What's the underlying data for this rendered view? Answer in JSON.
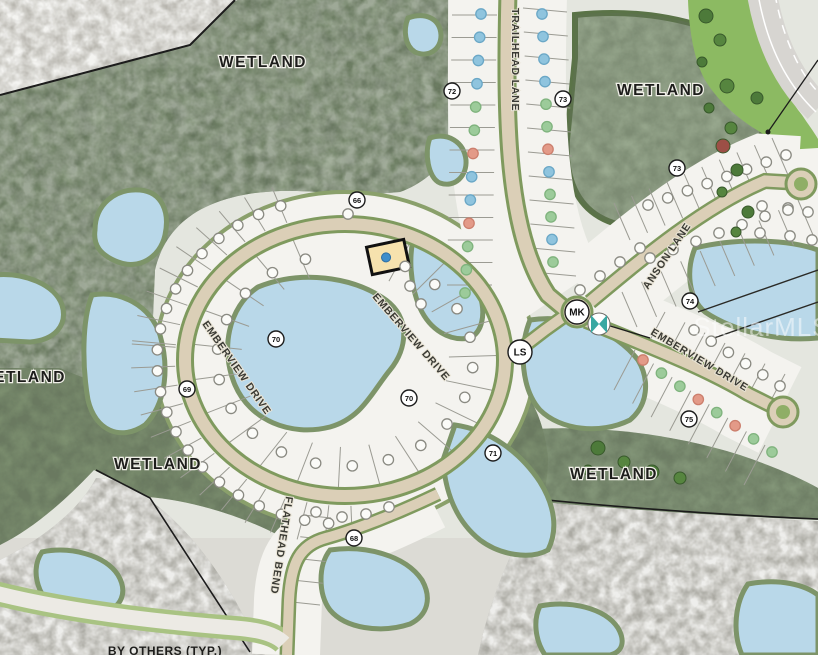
{
  "map": {
    "watermark": {
      "text": "StellarMLS",
      "x": 762,
      "y": 336,
      "size": 26,
      "color": "#ffffff",
      "opacity": 0.5
    },
    "area_labels": [
      {
        "text": "WETLAND",
        "x": 263,
        "y": 67
      },
      {
        "text": "WETLAND",
        "x": 661,
        "y": 95
      },
      {
        "text": "WETLAND",
        "x": 22,
        "y": 382
      },
      {
        "text": "WETLAND",
        "x": 158,
        "y": 469
      },
      {
        "text": "WETLAND",
        "x": 614,
        "y": 479
      }
    ],
    "note_labels": [
      {
        "text": "BY OTHERS (TYP.)",
        "x": 165,
        "y": 655
      }
    ],
    "street_labels": [
      {
        "text": "TRAILHEAD LANE",
        "x": 512,
        "y": 8,
        "rotate": 90
      },
      {
        "text": "EMBERVIEW DRIVE",
        "x": 372,
        "y": 297,
        "rotate": 49
      },
      {
        "text": "EMBERVIEW DRIVE",
        "x": 202,
        "y": 324,
        "rotate": 55
      },
      {
        "text": "EMBERVIEW DRIVE",
        "x": 650,
        "y": 334,
        "rotate": 31
      },
      {
        "text": "ANSON LANE",
        "x": 648,
        "y": 290,
        "rotate": -56
      },
      {
        "text": "FLATHEAD BEND",
        "x": 286,
        "y": 496,
        "rotate": 99
      }
    ],
    "markers": [
      {
        "label": "72",
        "x": 452,
        "y": 91,
        "size": "s"
      },
      {
        "label": "73",
        "x": 563,
        "y": 99,
        "size": "s"
      },
      {
        "label": "66",
        "x": 357,
        "y": 200,
        "size": "s"
      },
      {
        "label": "73",
        "x": 677,
        "y": 168,
        "size": "s"
      },
      {
        "label": "74",
        "x": 690,
        "y": 301,
        "size": "s"
      },
      {
        "label": "75",
        "x": 689,
        "y": 419,
        "size": "s"
      },
      {
        "label": "70",
        "x": 276,
        "y": 339,
        "size": "s"
      },
      {
        "label": "69",
        "x": 187,
        "y": 389,
        "size": "s"
      },
      {
        "label": "70",
        "x": 409,
        "y": 398,
        "size": "s"
      },
      {
        "label": "71",
        "x": 493,
        "y": 453,
        "size": "s"
      },
      {
        "label": "68",
        "x": 354,
        "y": 538,
        "size": "s"
      },
      {
        "label": "MK",
        "x": 577,
        "y": 312,
        "size": "l"
      },
      {
        "label": "LS",
        "x": 520,
        "y": 352,
        "size": "l"
      }
    ],
    "highlighted_lot": {
      "x": 388,
      "y": 257,
      "w": 38,
      "h": 28,
      "rotate": -12,
      "fill": "#f6e2ae",
      "border": "#111111",
      "dot": "#3f8ecb"
    },
    "dot_colors": {
      "o": {
        "fill": "#fbfbf8",
        "stroke": "#8a8a82"
      },
      "t": {
        "fill": "#8fc4de",
        "stroke": "#6aa7c6"
      },
      "g": {
        "fill": "#9ccb9a",
        "stroke": "#7fb37d"
      },
      "r": {
        "fill": "#e39a88",
        "stroke": "#cc7f6d"
      }
    },
    "dot_rows": [
      {
        "type": "line",
        "x1": 481,
        "y1": 14,
        "x2": 465,
        "y2": 293,
        "count": 13,
        "colors": "ttttggrttrggg"
      },
      {
        "type": "line",
        "x1": 542,
        "y1": 14,
        "x2": 553,
        "y2": 262,
        "count": 12,
        "colors": "ttttggrtggtg"
      },
      {
        "type": "arc",
        "cx": 345,
        "cy": 360,
        "rx": 188,
        "ry": 164,
        "a1": 250,
        "a2": 95,
        "count": 22,
        "colors": "o"
      },
      {
        "type": "arc",
        "cx": 345,
        "cy": 360,
        "rx": 128,
        "ry": 106,
        "a1": 252,
        "a2": -62,
        "count": 20,
        "colors": "o"
      },
      {
        "type": "line",
        "x1": 648,
        "y1": 205,
        "x2": 786,
        "y2": 155,
        "count": 8,
        "colors": "o"
      },
      {
        "type": "line",
        "x1": 650,
        "y1": 258,
        "x2": 788,
        "y2": 208,
        "count": 7,
        "colors": "o"
      },
      {
        "type": "line",
        "x1": 580,
        "y1": 290,
        "x2": 640,
        "y2": 248,
        "count": 4,
        "colors": "o"
      },
      {
        "type": "line",
        "x1": 694,
        "y1": 330,
        "x2": 780,
        "y2": 386,
        "count": 6,
        "colors": "o"
      },
      {
        "type": "line",
        "x1": 643,
        "y1": 360,
        "x2": 772,
        "y2": 452,
        "count": 8,
        "colors": "rggrgrgg"
      },
      {
        "type": "list",
        "pts": [
          [
            762,
            206
          ],
          [
            788,
            210
          ],
          [
            808,
            212
          ],
          [
            760,
            233
          ],
          [
            790,
            236
          ],
          [
            812,
            240
          ]
        ],
        "colors": "o"
      },
      {
        "type": "list",
        "pts": [
          [
            316,
            512
          ],
          [
            342,
            517
          ],
          [
            366,
            514
          ],
          [
            389,
            507
          ]
        ],
        "colors": "o"
      },
      {
        "type": "list",
        "pts": [
          [
            348,
            214
          ],
          [
            410,
            286
          ],
          [
            421,
            304
          ]
        ],
        "colors": "o"
      }
    ],
    "tick_rows": [
      {
        "type": "radial",
        "cx": 345,
        "cy": 360,
        "rx1": 170,
        "ry1": 146,
        "rx2": 214,
        "ry2": 184,
        "a1": 185,
        "a2": 88,
        "count": 14
      },
      {
        "type": "radial",
        "cx": 345,
        "cy": 360,
        "rx1": 170,
        "ry1": 146,
        "rx2": 214,
        "ry2": 184,
        "a1": 250,
        "a2": 186,
        "count": 9
      },
      {
        "type": "radial",
        "cx": 345,
        "cy": 360,
        "rx1": 104,
        "ry1": 87,
        "rx2": 152,
        "ry2": 128,
        "a1": 250,
        "a2": -65,
        "count": 21
      },
      {
        "type": "band",
        "x1": 452,
        "y1": 15,
        "x2": 447,
        "y2": 285,
        "dx": 45,
        "dy": 0,
        "count": 13
      },
      {
        "type": "band",
        "x1": 523,
        "y1": 8,
        "x2": 532,
        "y2": 272,
        "dx": 44,
        "dy": 4,
        "count": 12
      },
      {
        "type": "band",
        "x1": 630,
        "y1": 240,
        "x2": 788,
        "y2": 175,
        "dx": -16,
        "dy": -37,
        "count": 10
      },
      {
        "type": "band",
        "x1": 622,
        "y1": 292,
        "x2": 798,
        "y2": 200,
        "dx": 15,
        "dy": 35,
        "count": 10
      },
      {
        "type": "band",
        "x1": 650,
        "y1": 340,
        "x2": 770,
        "y2": 402,
        "dx": 15,
        "dy": -28,
        "count": 7
      },
      {
        "type": "band",
        "x1": 635,
        "y1": 350,
        "x2": 765,
        "y2": 445,
        "dx": -21,
        "dy": 40,
        "count": 8
      },
      {
        "type": "band",
        "x1": 303,
        "y1": 515,
        "x2": 292,
        "y2": 602,
        "dx": 28,
        "dy": 3,
        "count": 5
      }
    ],
    "trees": [
      {
        "x": 706,
        "y": 16,
        "r": 7,
        "c": "#4d7a3a"
      },
      {
        "x": 720,
        "y": 40,
        "r": 6,
        "c": "#56853f"
      },
      {
        "x": 702,
        "y": 62,
        "r": 5,
        "c": "#4d7a3a"
      },
      {
        "x": 727,
        "y": 86,
        "r": 7,
        "c": "#56853f"
      },
      {
        "x": 709,
        "y": 108,
        "r": 5,
        "c": "#4d7a3a"
      },
      {
        "x": 731,
        "y": 128,
        "r": 6,
        "c": "#56853f"
      },
      {
        "x": 723,
        "y": 146,
        "r": 7,
        "c": "#9c4f46"
      },
      {
        "x": 737,
        "y": 170,
        "r": 6,
        "c": "#4d7a3a"
      },
      {
        "x": 722,
        "y": 192,
        "r": 5,
        "c": "#56853f"
      },
      {
        "x": 748,
        "y": 212,
        "r": 6,
        "c": "#4d7a3a"
      },
      {
        "x": 736,
        "y": 232,
        "r": 5,
        "c": "#56853f"
      },
      {
        "x": 757,
        "y": 98,
        "r": 6,
        "c": "#4d7a3a"
      },
      {
        "x": 598,
        "y": 448,
        "r": 7,
        "c": "#4d7a3a"
      },
      {
        "x": 624,
        "y": 462,
        "r": 6,
        "c": "#56853f"
      },
      {
        "x": 652,
        "y": 472,
        "r": 7,
        "c": "#4d7a3a"
      },
      {
        "x": 680,
        "y": 478,
        "r": 6,
        "c": "#56853f"
      },
      {
        "x": 588,
        "y": 470,
        "r": 5,
        "c": "#4d7a3a"
      }
    ],
    "palette": {
      "forest": "#76886b",
      "wetland_green": "#99a98f",
      "wetland_gray": "#aaa9a2",
      "gray_rock": "#b6b4ad",
      "water": "#b9d8e9",
      "water_edge": "#7d9469",
      "lot_fill": "#f4f3ef",
      "lot_line": "#9b9b93",
      "road_fill": "#dbcfb7",
      "road_casing": "#7f9a5e",
      "verge_green": "#8cba62",
      "highway": "#d7d5d1",
      "boundary_line": "#1c1c1c"
    }
  }
}
